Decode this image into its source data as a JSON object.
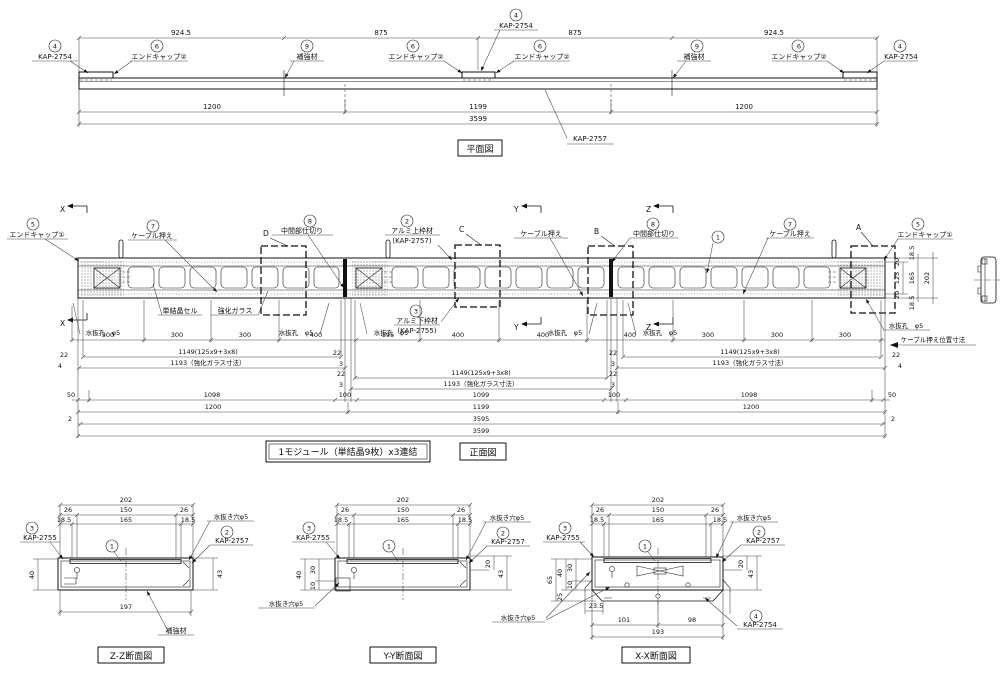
{
  "plan": {
    "title": "平面図",
    "dims_top": [
      "924.5",
      "875",
      "875",
      "924.5"
    ],
    "dims_mid": [
      "1200",
      "1199",
      "1200"
    ],
    "dim_total": "3599",
    "body_label": "KAP-2757",
    "callouts": [
      {
        "num": "4",
        "label": "KAP-2754"
      },
      {
        "num": "6",
        "label": "エンドキャップ②"
      },
      {
        "num": "9",
        "label": "補強材"
      },
      {
        "num": "6",
        "label": "エンドキャップ②"
      },
      {
        "num": "4",
        "label": "KAP-2754"
      },
      {
        "num": "6",
        "label": "エンドキャップ②"
      },
      {
        "num": "9",
        "label": "補強材"
      },
      {
        "num": "6",
        "label": "エンドキャップ②"
      },
      {
        "num": "4",
        "label": "KAP-2754"
      }
    ]
  },
  "front": {
    "title": "正面図",
    "module_note": "1モジュール（単結晶9枚）x3連結",
    "callouts": [
      {
        "num": "5",
        "label": "エンドキャップ①"
      },
      {
        "num": "7",
        "label": "ケーブル押え"
      },
      {
        "num": "8",
        "label": "中間部仕切り"
      },
      {
        "num": "2",
        "label": "アルミ上枠材",
        "label2": "(KAP-2757)"
      },
      {
        "num": "",
        "label": "ケーブル押え"
      },
      {
        "num": "8",
        "label": "中間部仕切り"
      },
      {
        "num": "1",
        "label": ""
      },
      {
        "num": "7",
        "label": "ケーブル押え"
      },
      {
        "num": "5",
        "label": "エンドキャップ①"
      },
      {
        "num": "3",
        "label": "アルミ下枠材",
        "label2": "(KAP-2755)"
      }
    ],
    "labels": {
      "cell": "単結晶セル",
      "glass": "強化ガラス",
      "drain": "水抜孔　φ5",
      "cable_note": "ケーブル押え位置寸法"
    },
    "section_letters": {
      "x": "X",
      "y": "Y",
      "z": "Z",
      "a": "A",
      "b": "B",
      "c": "C",
      "d": "D"
    },
    "right_dims": [
      "20",
      "125",
      "20",
      "18.5",
      "165",
      "18.5",
      "202"
    ],
    "rows": {
      "a": [
        "300",
        "300",
        "300",
        "400",
        "195",
        "400",
        "400",
        "400",
        "300",
        "300",
        "300"
      ],
      "b": "1149(125x9+3x8)",
      "c": "1193（強化ガラス寸法）",
      "d": [
        "50",
        "1098",
        "100",
        "1099",
        "100",
        "1098",
        "50"
      ],
      "e": [
        "1200",
        "1199",
        "1200"
      ],
      "f": "3595",
      "f_end": "2",
      "g": "3599",
      "joint": [
        "22",
        "3"
      ],
      "edge": [
        "22",
        "4"
      ]
    }
  },
  "sections": {
    "top_dims": {
      "total": "202",
      "row2": [
        "26",
        "150",
        "26"
      ],
      "row3": [
        "18.5",
        "165",
        "18.5"
      ]
    },
    "zz": {
      "title": "Z-Z断面図",
      "c3num": "3",
      "c3": "KAP-2755",
      "c1": "1",
      "c2num": "2",
      "c2": "KAP-2757",
      "drain": "水抜き穴φ5",
      "left": "40",
      "right": "43",
      "bottom": "197",
      "part": "補強材"
    },
    "yy": {
      "title": "Y-Y断面図",
      "c3num": "3",
      "c3": "KAP-2755",
      "c1": "1",
      "c2num": "2",
      "c2": "KAP-2757",
      "drain_top": "水抜き穴φ5",
      "drain_bottom": "水抜き穴φ5",
      "left": [
        "40",
        "30",
        "10"
      ],
      "right": [
        "20",
        "43"
      ]
    },
    "xx": {
      "title": "X-X断面図",
      "c3num": "3",
      "c3": "KAP-2755",
      "c1": "1",
      "c2num": "2",
      "c2": "KAP-2757",
      "c4num": "4",
      "c4": "KAP-2754",
      "drain_top": "水抜き穴φ5",
      "drain_bottom": "水抜き穴φ5",
      "left": [
        "65",
        "40",
        "30",
        "10",
        "25"
      ],
      "right": [
        "20",
        "43"
      ],
      "bottom": [
        "23.5",
        "101",
        "98",
        "193"
      ]
    }
  }
}
